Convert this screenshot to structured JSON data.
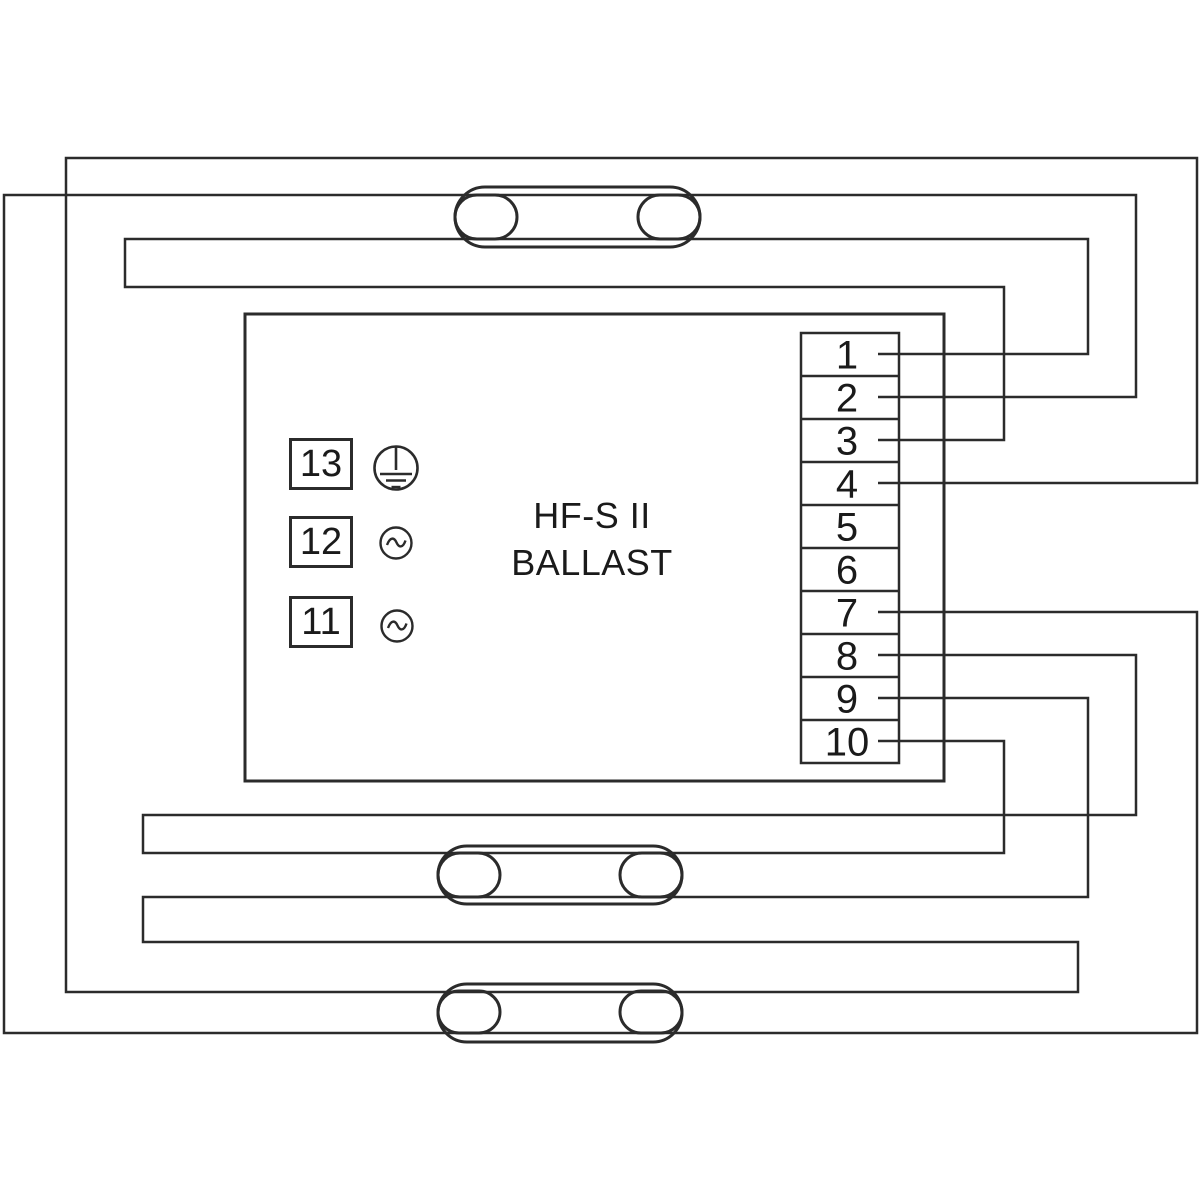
{
  "canvas": {
    "width": 1200,
    "height": 1200,
    "background": "#ffffff",
    "line_color": "#2b2b2b",
    "text_color": "#1a1a1a"
  },
  "ballast": {
    "label_line1": "HF-S II",
    "label_line2": "BALLAST",
    "box": {
      "x": 245,
      "y": 314,
      "width": 699,
      "height": 467
    }
  },
  "terminal_block": {
    "box": {
      "x": 801,
      "y": 333,
      "width": 98,
      "height": 430
    },
    "cell_height": 43,
    "terminals": [
      "1",
      "2",
      "3",
      "4",
      "5",
      "6",
      "7",
      "8",
      "9",
      "10"
    ]
  },
  "mains_connectors": [
    {
      "label": "13",
      "symbol": "protective-earth"
    },
    {
      "label": "12",
      "symbol": "ac"
    },
    {
      "label": "11",
      "symbol": "ac"
    }
  ],
  "lamps": [
    {
      "name": "lamp-1",
      "tube": {
        "x": 455,
        "y": 187,
        "width": 245,
        "height": 60
      },
      "electrodes": [
        {
          "x": 455,
          "y": 195,
          "width": 62,
          "height": 44
        },
        {
          "x": 638,
          "y": 195,
          "width": 62,
          "height": 44
        }
      ]
    },
    {
      "name": "lamp-2",
      "tube": {
        "x": 438,
        "y": 846,
        "width": 244,
        "height": 58
      },
      "electrodes": [
        {
          "x": 438,
          "y": 853,
          "width": 62,
          "height": 44
        },
        {
          "x": 620,
          "y": 853,
          "width": 62,
          "height": 44
        }
      ]
    },
    {
      "name": "lamp-3",
      "tube": {
        "x": 438,
        "y": 984,
        "width": 244,
        "height": 58
      },
      "electrodes": [
        {
          "x": 438,
          "y": 991,
          "width": 62,
          "height": 42
        },
        {
          "x": 620,
          "y": 991,
          "width": 62,
          "height": 42
        }
      ]
    }
  ],
  "wires": [
    {
      "name": "wire-terminal1-lamp1-terminal3",
      "points": [
        [
          878,
          354
        ],
        [
          1088,
          354
        ],
        [
          1088,
          239
        ],
        [
          125,
          239
        ],
        [
          125,
          287
        ],
        [
          1004,
          287
        ],
        [
          1004,
          440
        ],
        [
          878,
          440
        ]
      ]
    },
    {
      "name": "wire-terminal2-lamp1-lamp3-terminal7",
      "points": [
        [
          878,
          397
        ],
        [
          1136,
          397
        ],
        [
          1136,
          195
        ],
        [
          4,
          195
        ],
        [
          4,
          1033
        ],
        [
          1197,
          1033
        ],
        [
          1197,
          612
        ],
        [
          878,
          612
        ]
      ]
    },
    {
      "name": "wire-terminal4-lamp3-lamp2-terminal9",
      "points": [
        [
          878,
          483
        ],
        [
          1197,
          483
        ],
        [
          1197,
          158
        ],
        [
          66,
          158
        ],
        [
          66,
          992
        ],
        [
          1078,
          992
        ],
        [
          1078,
          942
        ],
        [
          143,
          942
        ],
        [
          143,
          897
        ],
        [
          1088,
          897
        ],
        [
          1088,
          698
        ],
        [
          878,
          698
        ]
      ]
    },
    {
      "name": "wire-terminal8-lamp2-terminal10",
      "points": [
        [
          878,
          655
        ],
        [
          1136,
          655
        ],
        [
          1136,
          815
        ],
        [
          143,
          815
        ],
        [
          143,
          853
        ],
        [
          1004,
          853
        ],
        [
          1004,
          741
        ],
        [
          878,
          741
        ]
      ]
    }
  ]
}
